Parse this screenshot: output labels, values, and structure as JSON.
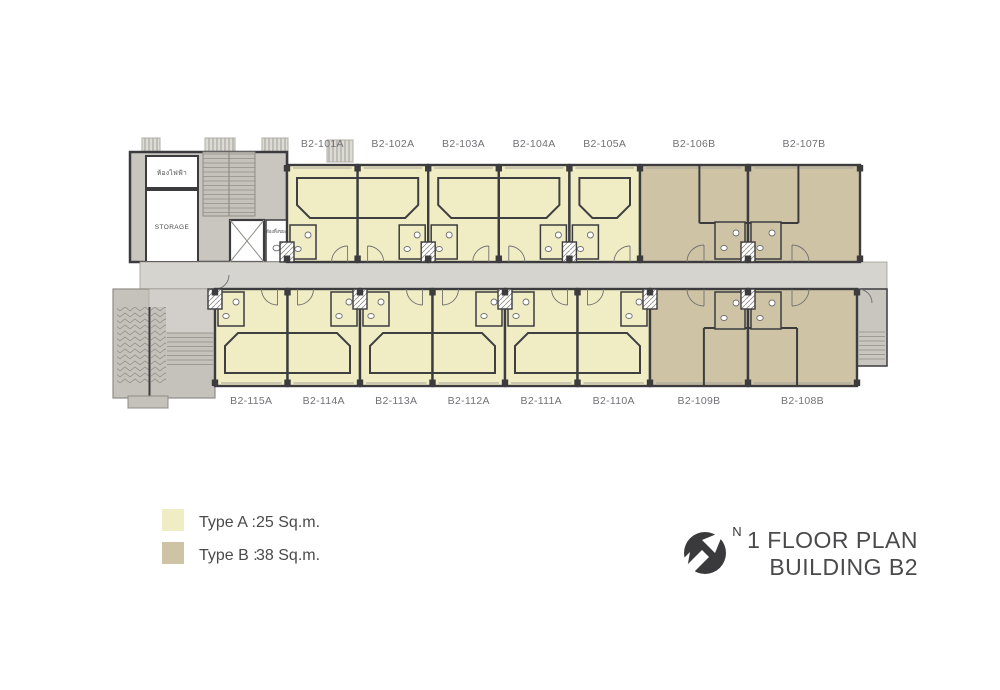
{
  "title": {
    "line1": "1 FLOOR PLAN",
    "line2": "BUILDING B2",
    "north_label": "N"
  },
  "legend": {
    "items": [
      {
        "name": "Type A :",
        "area": "25 Sq.m.",
        "color": "#f0edc5"
      },
      {
        "name": "Type B :",
        "area": "38 Sq.m.",
        "color": "#cec4a5"
      }
    ]
  },
  "plan": {
    "colors": {
      "type_a": "#f0edc5",
      "type_b": "#cec4a5",
      "corridor": "#d6d4cf",
      "service": "#c9c6c0",
      "stair": "#c5c2bb",
      "lobby": "#d2cfca",
      "wall": "#3c3c3e",
      "thin_line": "#8f8c86",
      "fixture": "#6f6f72",
      "room_label": "#717276",
      "text_dark": "#4a4a4c"
    },
    "units_top": [
      {
        "id": "B2-101A",
        "type": "A"
      },
      {
        "id": "B2-102A",
        "type": "A"
      },
      {
        "id": "B2-103A",
        "type": "A"
      },
      {
        "id": "B2-104A",
        "type": "A"
      },
      {
        "id": "B2-105A",
        "type": "A"
      },
      {
        "id": "B2-106B",
        "type": "B"
      },
      {
        "id": "B2-107B",
        "type": "B"
      }
    ],
    "units_bottom": [
      {
        "id": "B2-115A",
        "type": "A"
      },
      {
        "id": "B2-114A",
        "type": "A"
      },
      {
        "id": "B2-113A",
        "type": "A"
      },
      {
        "id": "B2-112A",
        "type": "A"
      },
      {
        "id": "B2-111A",
        "type": "A"
      },
      {
        "id": "B2-110A",
        "type": "A"
      },
      {
        "id": "B2-109B",
        "type": "B"
      },
      {
        "id": "B2-108B",
        "type": "B"
      }
    ],
    "service_rooms": {
      "electrical": "ห้องไฟฟ้า",
      "storage": "STORAGE",
      "waste": "ห้องทิ้งขยะ"
    }
  }
}
